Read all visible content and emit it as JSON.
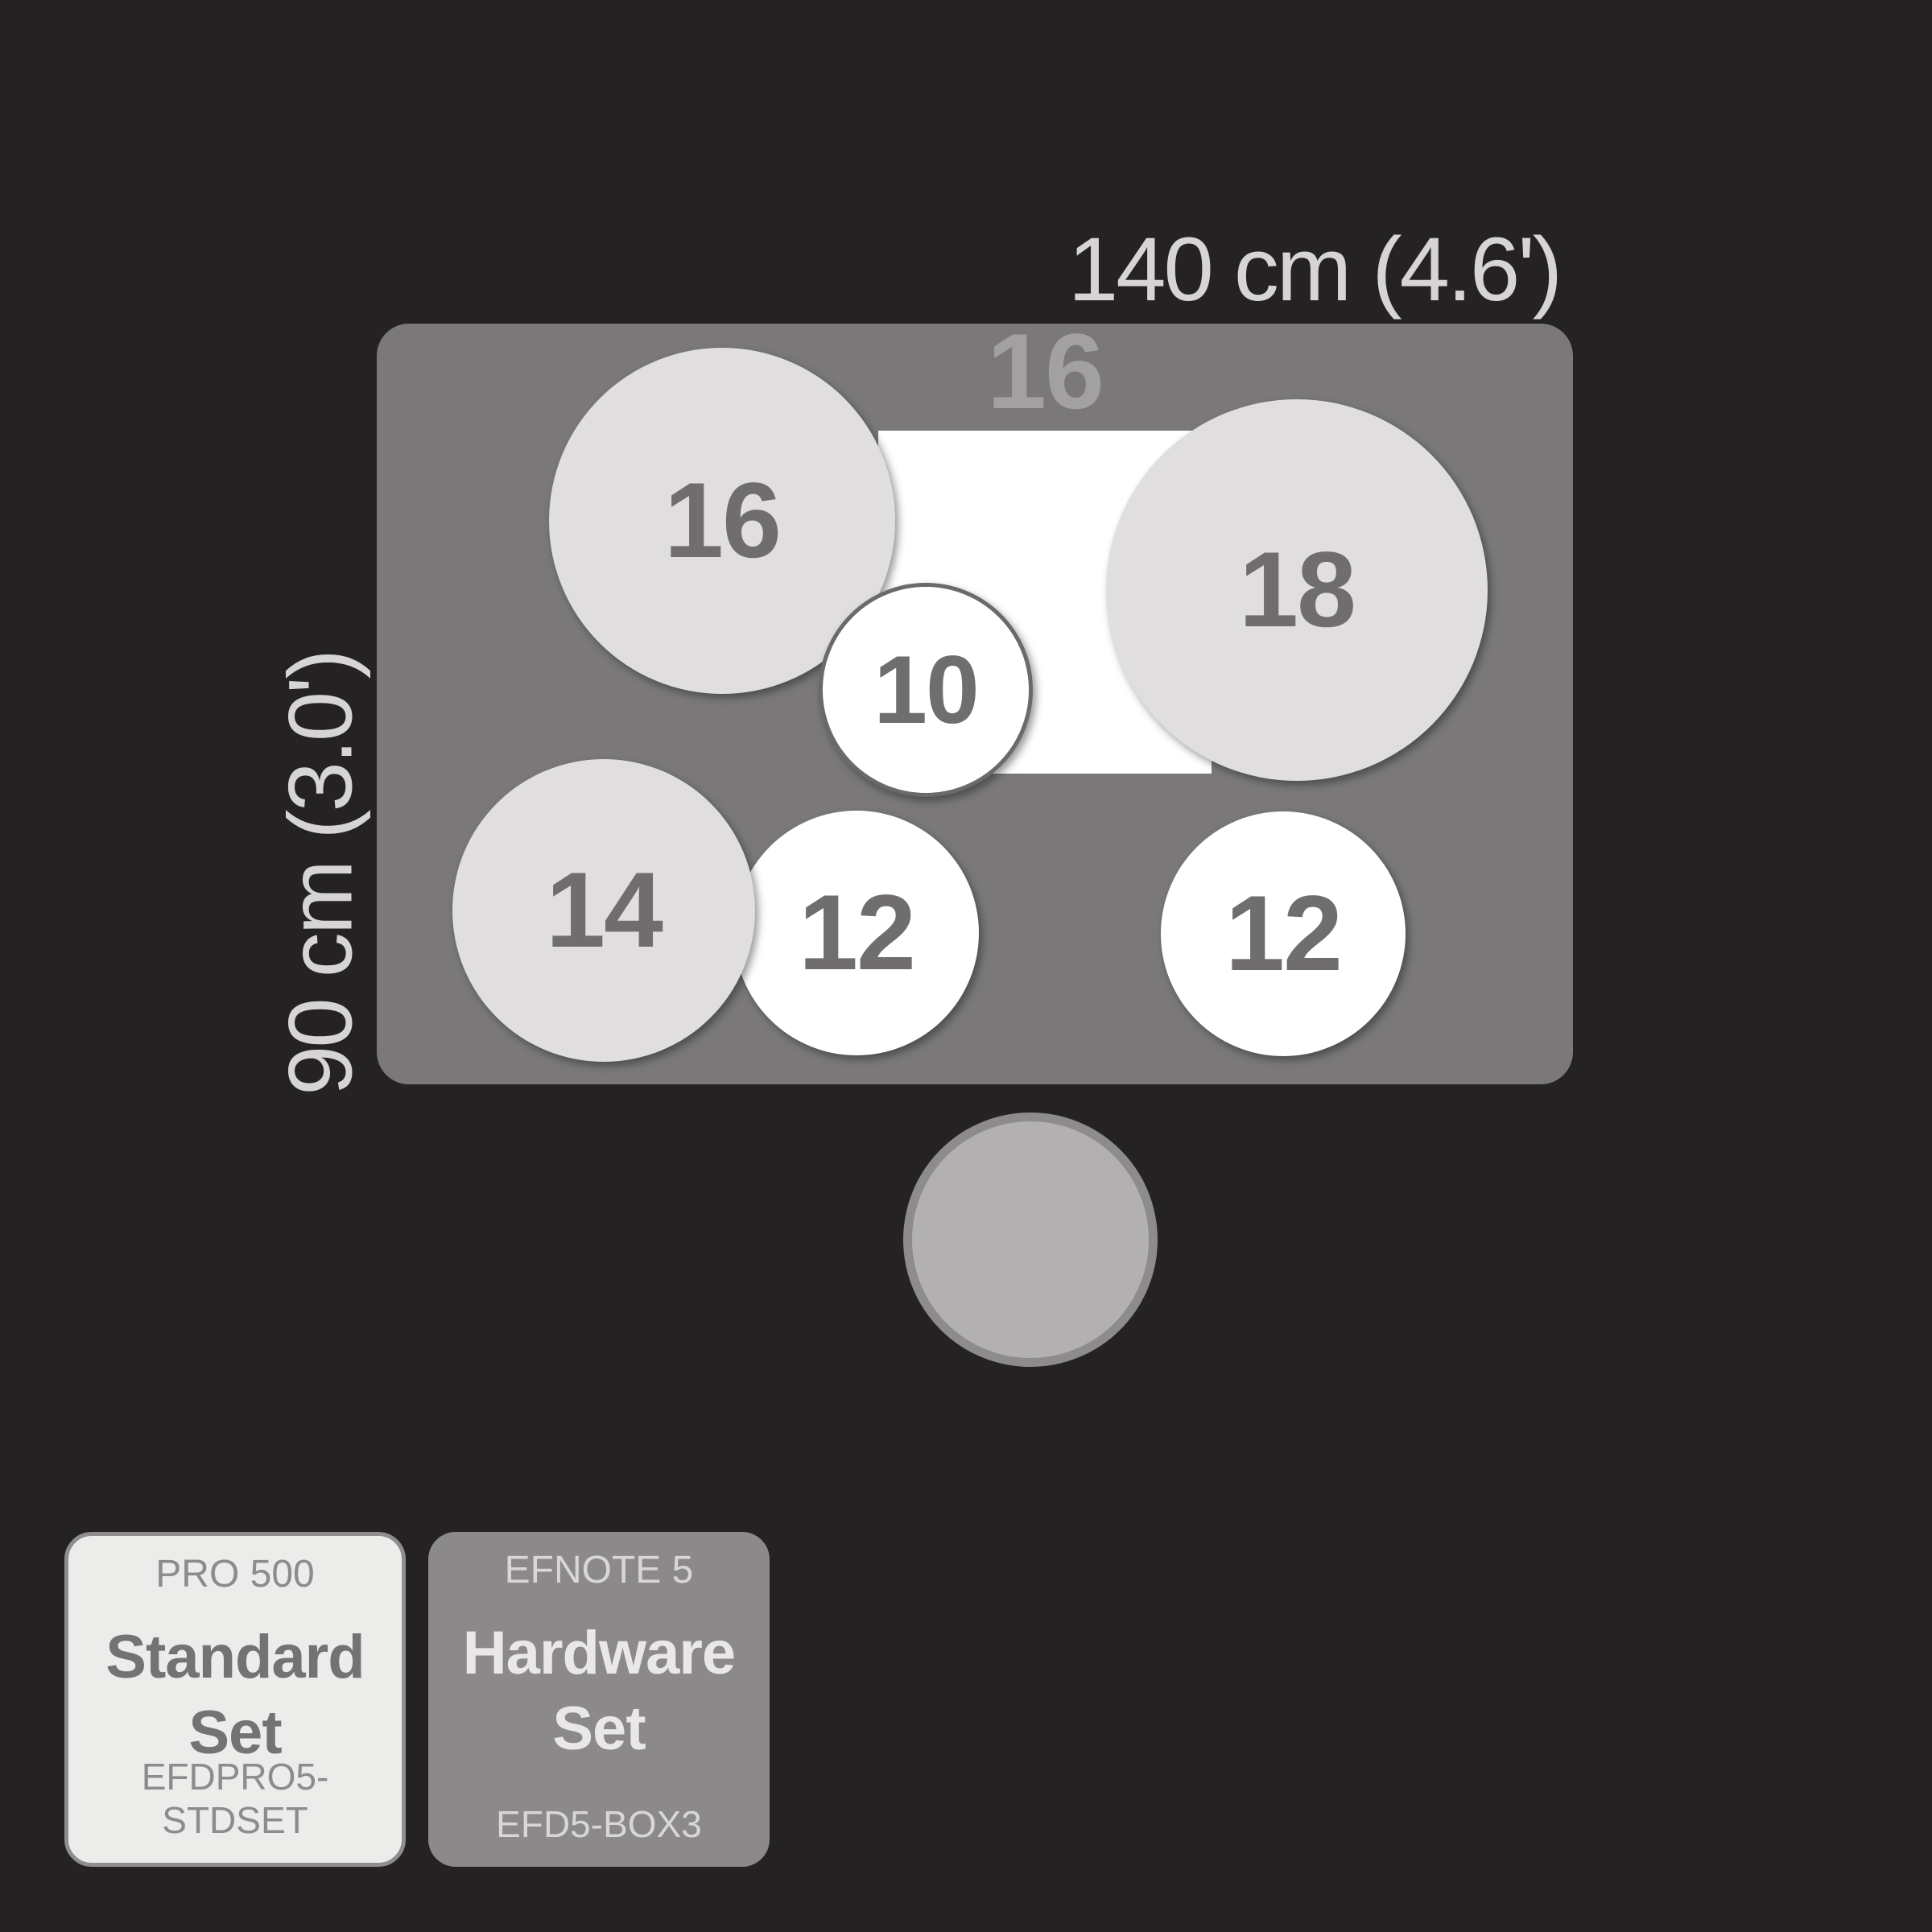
{
  "diagram": {
    "width_label": "140 cm (4.6')",
    "height_label": "90 cm (3.0')",
    "kick": {
      "label": "16"
    },
    "pads": [
      {
        "name": "crash-cymbal-left",
        "size": "16"
      },
      {
        "name": "crash-cymbal-right",
        "size": "18"
      },
      {
        "name": "tom-10",
        "size": "10"
      },
      {
        "name": "floor-tom-14",
        "size": "14"
      },
      {
        "name": "tom-12-left",
        "size": "12"
      },
      {
        "name": "tom-12-right",
        "size": "12"
      }
    ],
    "colors": {
      "background": "#242222",
      "rug": "#7a7878",
      "pad_light": "#e0dede",
      "pad_white": "#ffffff",
      "throne": "#b2b0b0",
      "number_text": "#6f6d6d",
      "dimension_text": "#d6d4d4"
    }
  },
  "cards": [
    {
      "series": "PRO 500",
      "title_lines": [
        "Standard",
        "Set"
      ],
      "sku": "EFDPRO5-STDSET"
    },
    {
      "series": "EFNOTE 5",
      "title_lines": [
        "Hardware",
        "Set"
      ],
      "sku": "EFD5-BOX3"
    }
  ]
}
